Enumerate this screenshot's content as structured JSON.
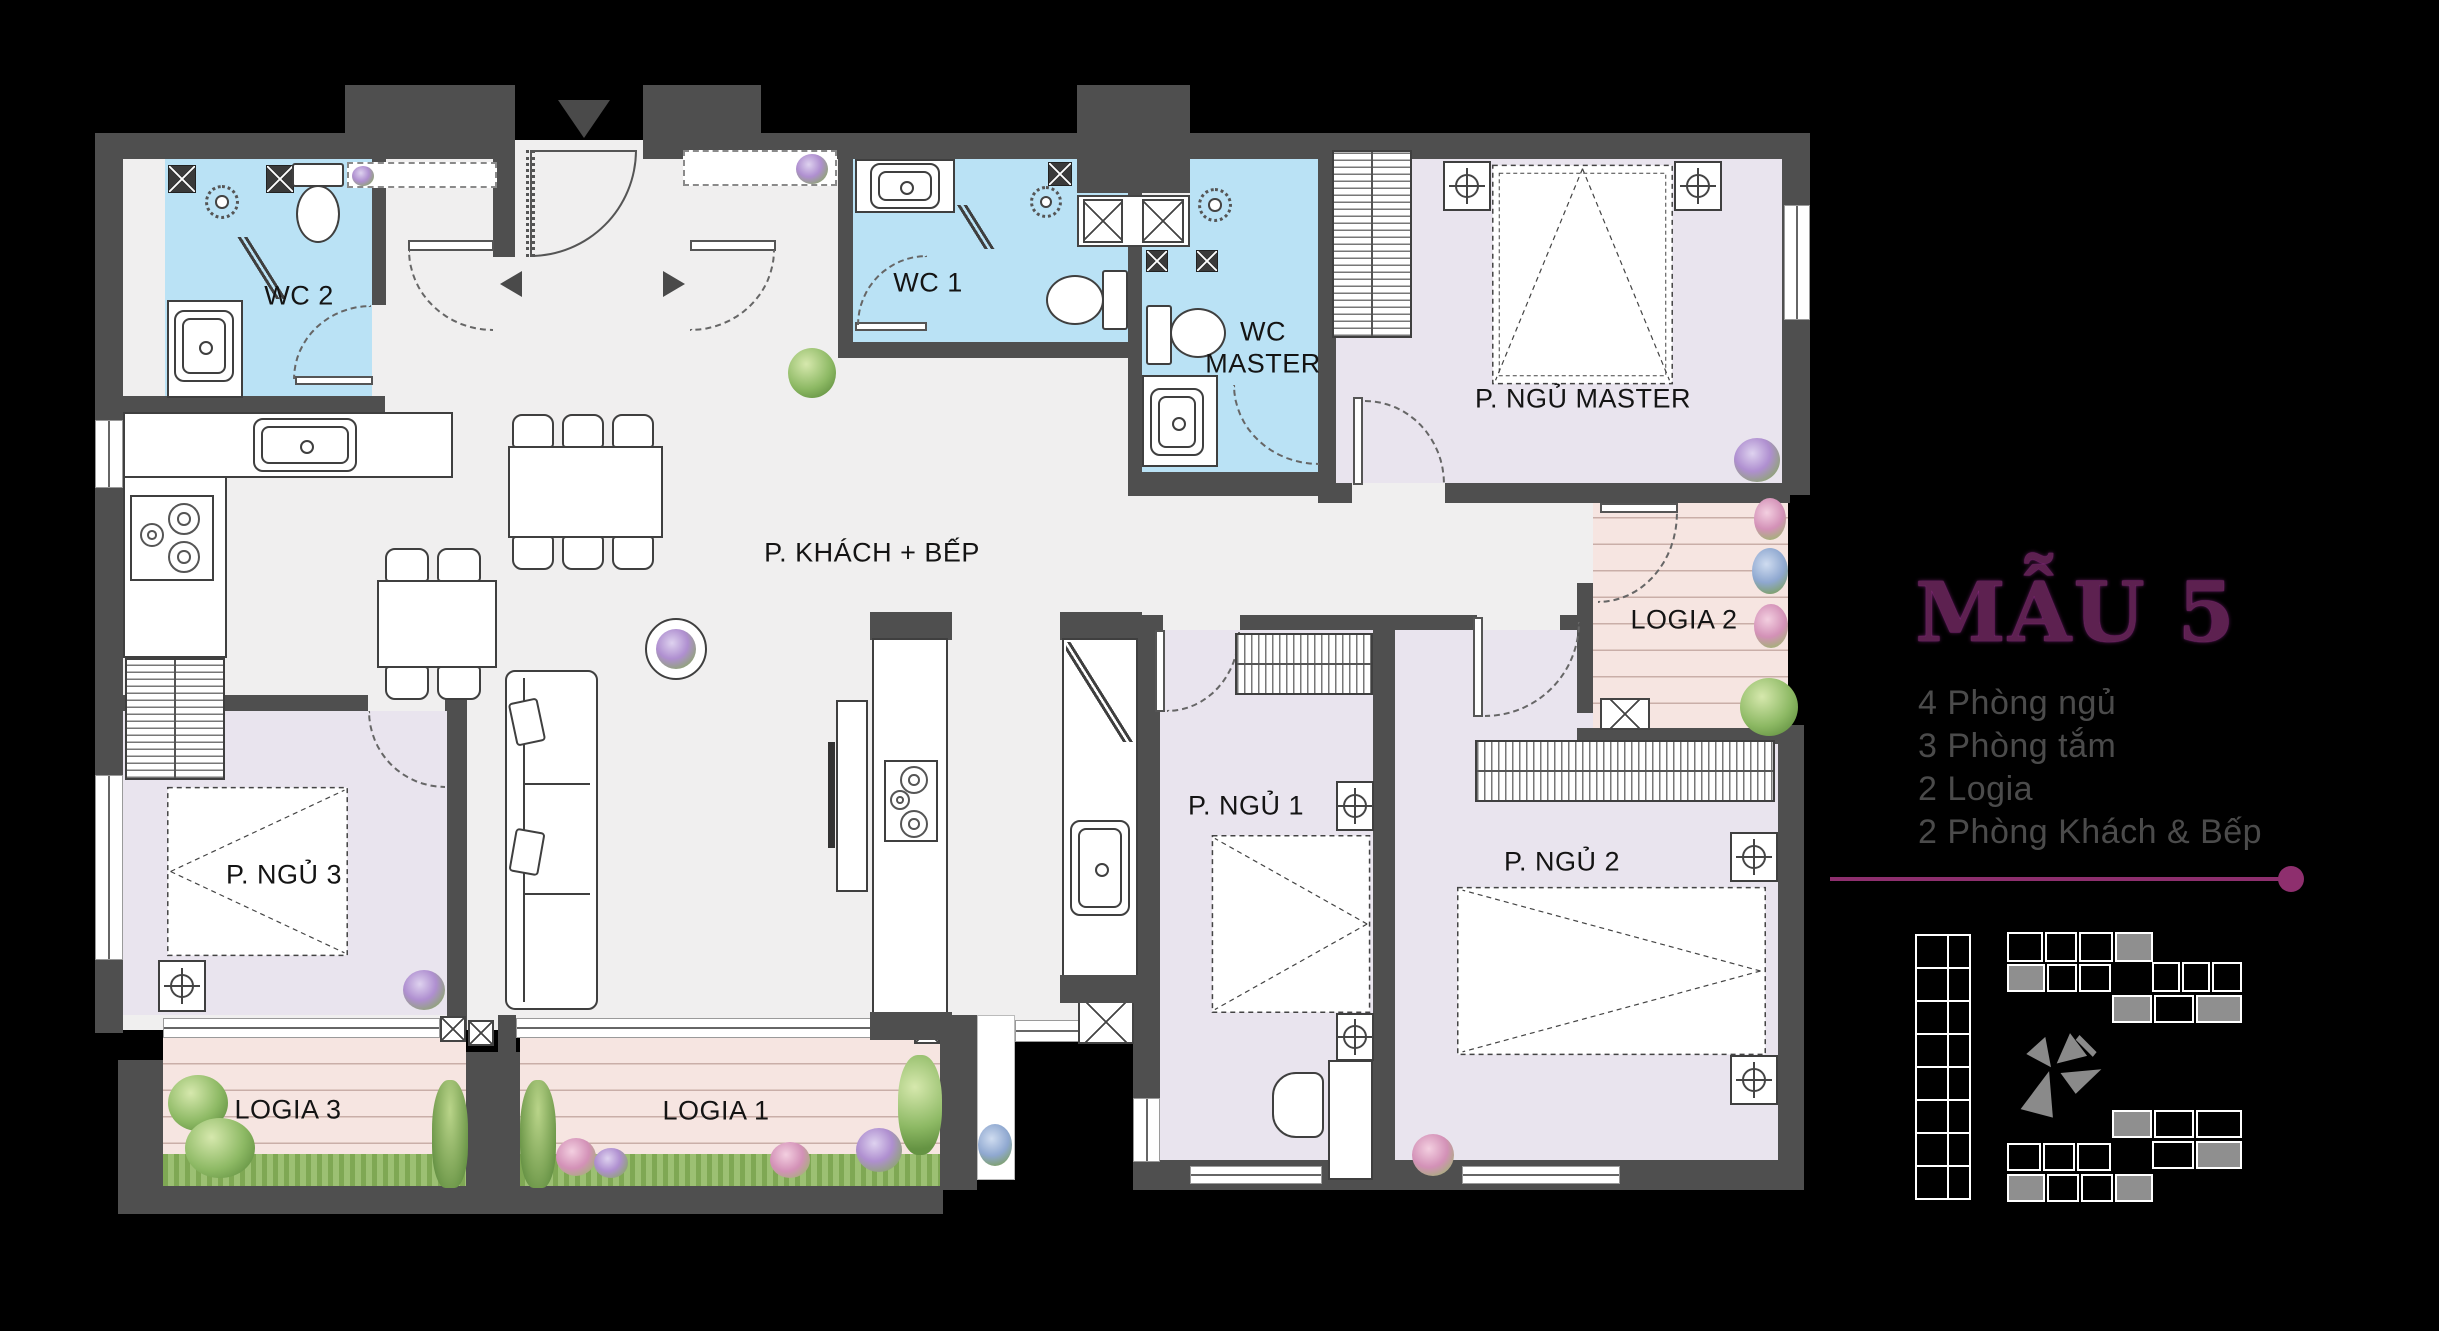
{
  "panel": {
    "title": "MẪU 5",
    "features": [
      "4 Phòng ngủ",
      "3 Phòng tắm",
      "2 Logia",
      "2 Phòng Khách & Bếp"
    ]
  },
  "rooms": {
    "wc2": "WC 2",
    "wc1": "WC 1",
    "wc_master": "WC MASTER",
    "master_bedroom": "P. NGỦ MASTER",
    "living_kitchen": "P. KHÁCH + BẾP",
    "bedroom1": "P. NGỦ 1",
    "bedroom2": "P. NGỦ 2",
    "bedroom3": "P. NGỦ 3",
    "logia1": "LOGIA 1",
    "logia2": "LOGIA 2",
    "logia3": "LOGIA 3"
  },
  "colors": {
    "background": "#000000",
    "wall": "#4f4f4f",
    "floor_main": "#f0efef",
    "floor_bedroom": "#e9e4ee",
    "floor_bathroom": "#bae2f5",
    "floor_logia": "#f6e5e1",
    "accent_purple": "#8e2f6e",
    "title_purple": "#5d2150",
    "feature_text": "#4b4b4b"
  }
}
